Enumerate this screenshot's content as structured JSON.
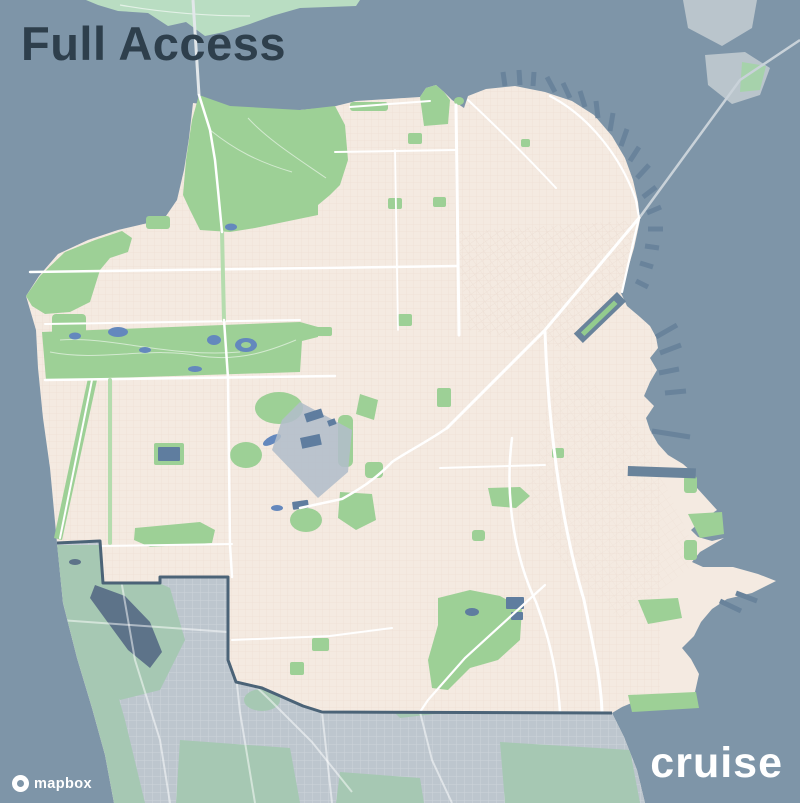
{
  "title": "Full Access",
  "branding": {
    "wordmark": "cruise"
  },
  "attribution": {
    "provider": "mapbox"
  },
  "map": {
    "colors": {
      "water": "#7E95A8",
      "land": "#F4EAE1",
      "grid": "#EADACF",
      "park": "#9DD096",
      "park-trail": "#FFFFFF",
      "land-muted": "#BDC6CE",
      "park-muted": "#A6C8B3",
      "lake": "#6488BD",
      "lake-muted": "#5D7389",
      "reservoir": "#5F7D9F",
      "pier": "#69839B",
      "road": "#FFFFFF",
      "green-boulevard": "#B5DCAE",
      "boundary": "#4B6377",
      "restricted": "#B2BDC9",
      "island": "#BAC5CC",
      "island-green": "#A6D2AB",
      "mint-land": "#B9DDC2",
      "bridge": "#C9D2D9",
      "title": "#2E3F4C"
    }
  }
}
